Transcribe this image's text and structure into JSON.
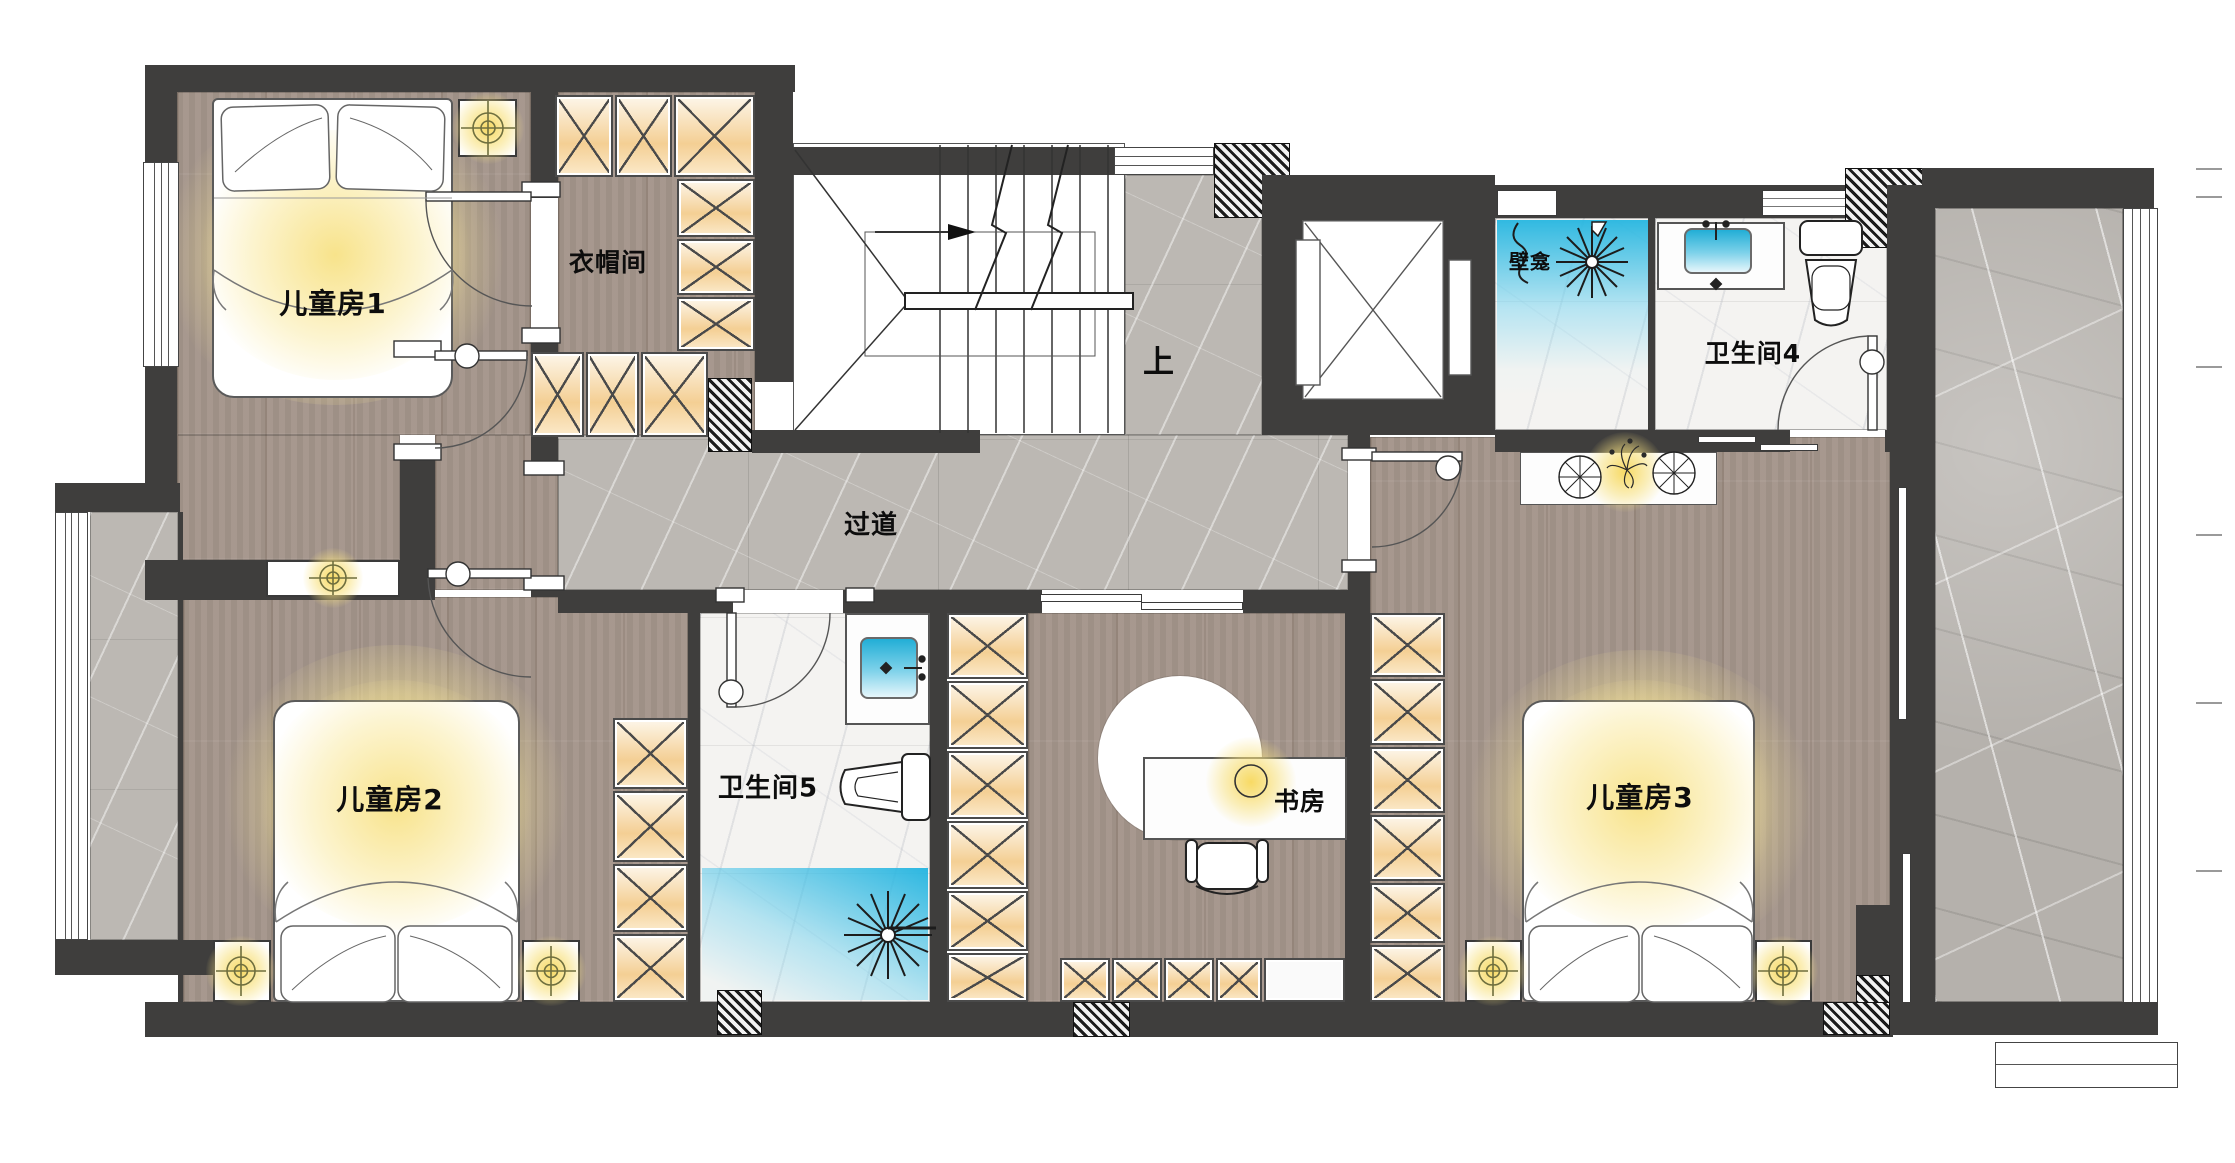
{
  "plan": {
    "labels": {
      "kids_room_1": "儿童房1",
      "cloakroom": "衣帽间",
      "stairs_up": "上",
      "niche": "壁龛",
      "bathroom_4": "卫生间4",
      "corridor": "过道",
      "kids_room_2": "儿童房2",
      "bathroom_5": "卫生间5",
      "study": "书房",
      "kids_room_3": "儿童房3"
    },
    "colors": {
      "wall": "#3f3e3d",
      "wood_floor": "#a4958b",
      "corridor_marble": "#bcb8b3",
      "bath_marble": "#f4f3f1",
      "terrace_marble": "#b5b1ac",
      "wardrobe_fill": "#f4cf94",
      "light_glow": "#f7dc6a",
      "water_blue": "#26b6e0"
    }
  }
}
